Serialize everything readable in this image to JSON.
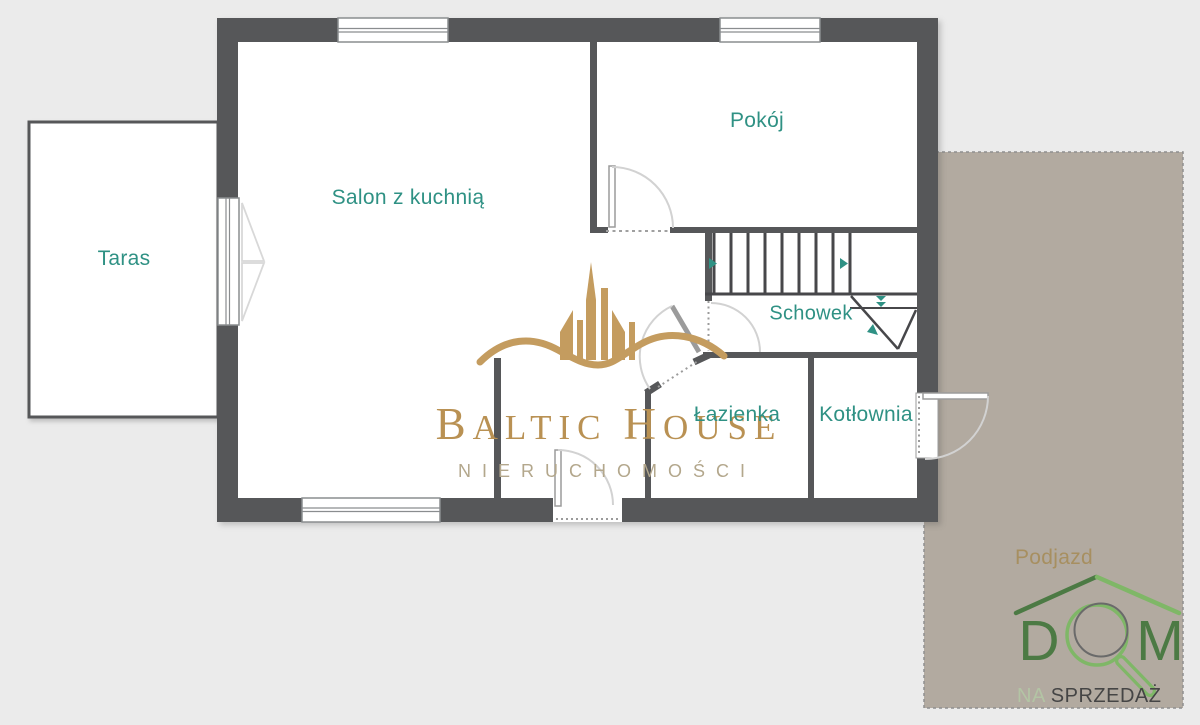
{
  "page": {
    "background": "#ebebeb"
  },
  "colors": {
    "wall": "#565759",
    "room_fill": "#ffffff",
    "label_teal": "#2f9184",
    "podjazd_fill": "#b2aaa0",
    "podjazd_label": "#a78f60",
    "watermark_gold": "#b99153",
    "watermark_icon_gold": "#c49c5f",
    "watermark_subtitle": "#b3a78c",
    "logo_green_dark": "#4c7a44",
    "logo_green_light": "#7fb767",
    "logo_sub_light": "#b3c4a4",
    "logo_sub_dark": "#454545"
  },
  "rooms": {
    "taras": "Taras",
    "salon": "Salon z kuchnią",
    "pokoj": "Pokój",
    "schowek": "Schowek",
    "lazienka": "Łazienka",
    "kotlownia": "Kotłownia",
    "podjazd": "Podjazd"
  },
  "watermark": {
    "brand_word1_initial": "B",
    "brand_word1_rest": "ALTIC",
    "brand_word2_initial": "H",
    "brand_word2_rest": "OUSE",
    "subtitle": "NIERUCHOMOŚCI"
  },
  "logo": {
    "letter_d": "D",
    "letter_m": "M",
    "sub_light": "NA",
    "sub_dark": "SPRZEDAŻ"
  },
  "icons": {
    "watermark_icon": "building-skyline-with-wave",
    "logo_icon": "magnifying-glass-under-roof",
    "stairs_icons": "stair-direction-arrows"
  }
}
